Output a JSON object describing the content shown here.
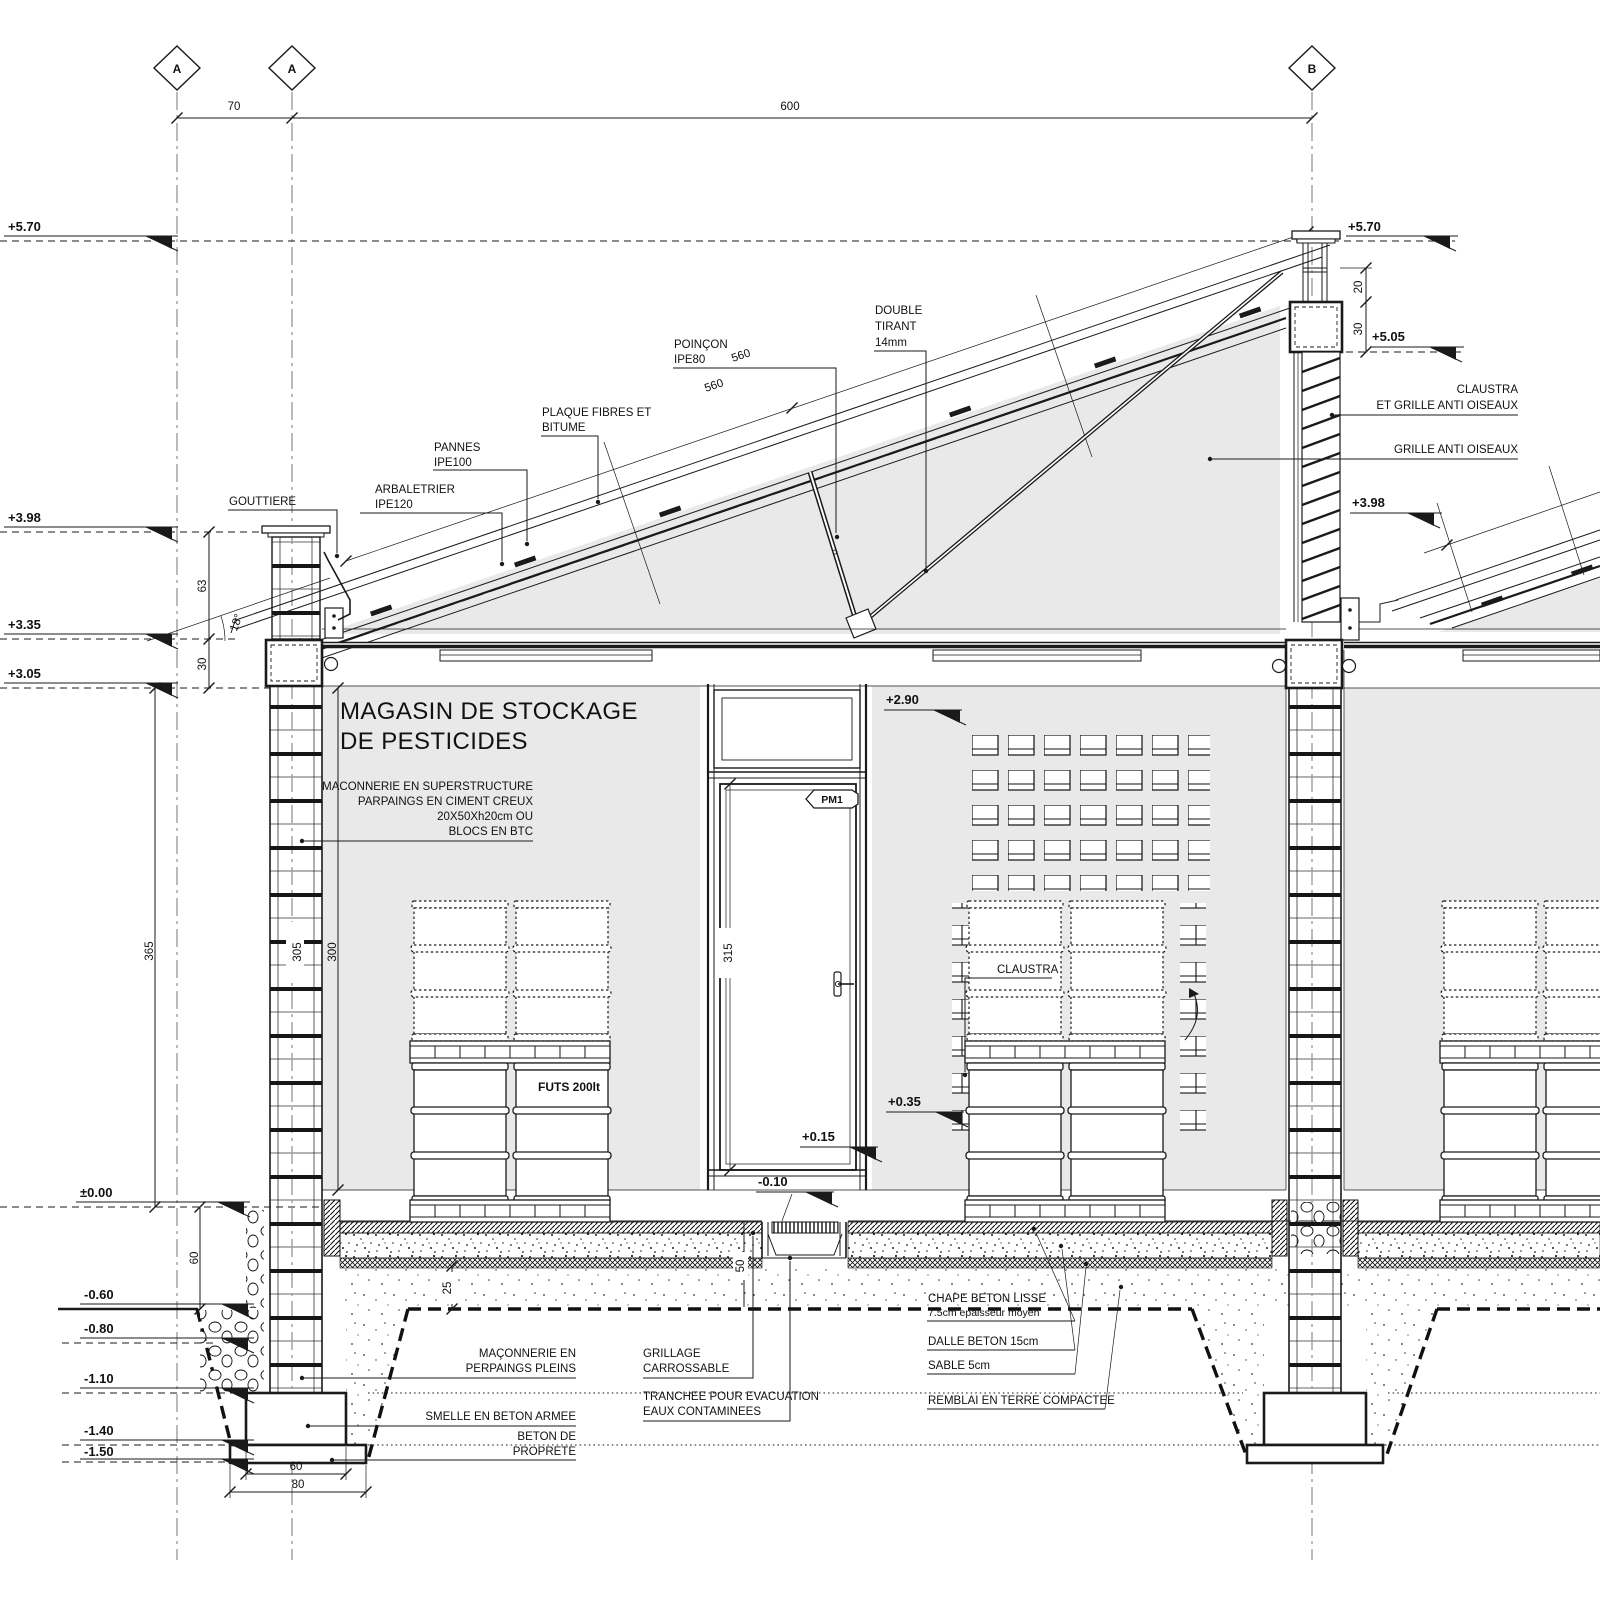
{
  "labels": {
    "grid_a1": "A",
    "grid_a2": "A",
    "grid_b": "B",
    "dim_top_70": "70",
    "dim_top_600": "600",
    "lv_570": "+5.70",
    "lv_570_r": "+5.70",
    "lv_505": "+5.05",
    "lv_398": "+3.98",
    "lv_398_r": "+3.98",
    "lv_335": "+3.35",
    "lv_305": "+3.05",
    "lv_000": "±0.00",
    "lv_m060": "-0.60",
    "lv_m080": "-0.80",
    "lv_m110": "-1.10",
    "lv_m140": "-1.40",
    "lv_m150": "-1.50",
    "lv_290": "+2.90",
    "lv_035": "+0.35",
    "lv_015": "+0.15",
    "lv_m010": "-0.10",
    "angle_18": "18°",
    "gouttiere": "GOUTTIERE",
    "arbaletrier": [
      "ARBALETRIER",
      "IPE120"
    ],
    "pannes": [
      "PANNES",
      "IPE100"
    ],
    "plaque": [
      "PLAQUE FIBRES ET",
      "BITUME"
    ],
    "poincon": [
      "POINÇON",
      "IPE80"
    ],
    "tirant": [
      "DOUBLE",
      "TIRANT",
      "14mm"
    ],
    "dim_560_a": "560",
    "dim_560_b": "560",
    "claustra_grille": [
      "CLAUSTRA",
      "ET GRILLE ANTI OISEAUX"
    ],
    "grille": "GRILLE ANTI OISEAUX",
    "title": [
      "MAGASIN DE STOCKAGE",
      "DE PESTICIDES"
    ],
    "maconnerie_note": [
      "MACONNERIE EN SUPERSTRUCTURE",
      "PARPAINGS EN CIMENT CREUX",
      "20X50Xh20cm OU",
      "BLOCS EN BTC"
    ],
    "pm1": "PM1",
    "claustra": "CLAUSTRA",
    "futs": "FUTS 200lt",
    "dim_63": "63",
    "dim_30_l": "30",
    "dim_365": "365",
    "dim_305": "305",
    "dim_300": "300",
    "dim_315": "315",
    "dim_60_v": "60",
    "dim_25": "25",
    "dim_50": "50",
    "dim_20_r": "20",
    "dim_30_r": "30",
    "dim_60_f": "60",
    "dim_80_f": "80",
    "maconnerie_perpaings": [
      "MAÇONNERIE EN",
      "PERPAINGS PLEINS"
    ],
    "grillage": [
      "GRILLAGE",
      "CARROSSABLE"
    ],
    "smelle": "SMELLE EN BETON ARMEE",
    "beton_proprete": [
      "BETON DE",
      "PROPRETE"
    ],
    "tranchee": [
      "TRANCHEE POUR EVACUATION",
      "EAUX CONTAMINEES"
    ],
    "chape": [
      "CHAPE BETON LISSE",
      "7.5cm epaisseur moyen"
    ],
    "dalle": "DALLE BETON 15cm",
    "sable": "SABLE 5cm",
    "remblai": "REMBLAI EN TERRE COMPACTEE"
  },
  "colors": {
    "ink": "#1a1a1a",
    "wall_fill": "#e9e9e9",
    "background": "#ffffff"
  }
}
